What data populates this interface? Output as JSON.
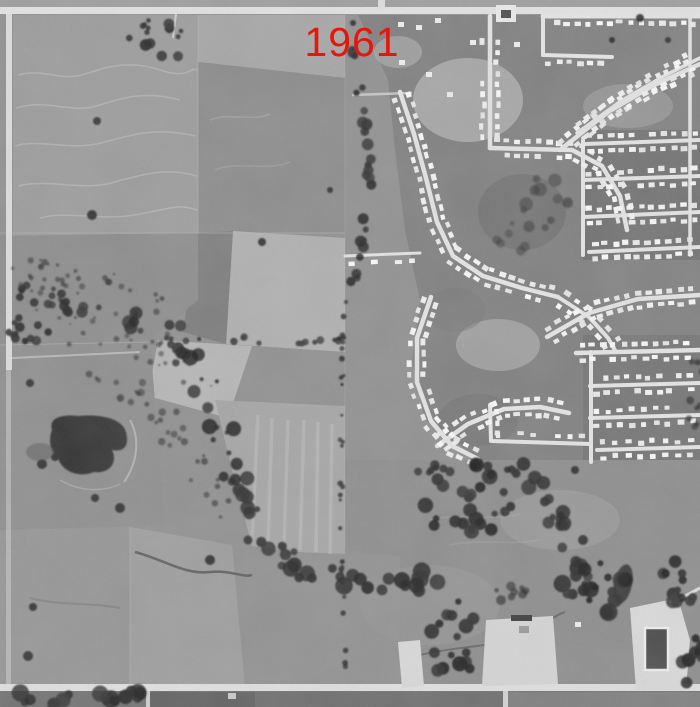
{
  "overlay": {
    "year_label": "1961",
    "color": "#e8150c"
  },
  "palette": {
    "field_mid": "#8f8f8f",
    "field_light": "#b2b2b2",
    "field_dark": "#757575",
    "suburb_ground": "#7e7e7e",
    "road": "#e6e6e6",
    "house": "#f0f0f0",
    "trees": "#262626",
    "water": "#2e2e2e"
  },
  "scene": {
    "house_defaults": {
      "spacing": 10.5,
      "offset": 7.2,
      "w": 6,
      "h": 4.6,
      "skip": 0.06
    },
    "streets": [
      {
        "pts": [
          [
            490,
            16
          ],
          [
            490,
            148
          ]
        ],
        "w": 4.5,
        "houses": {
          "sides": [
            -1,
            1
          ],
          "startD": 26
        }
      },
      {
        "pts": [
          [
            490,
            148
          ],
          [
            572,
            150
          ],
          [
            602,
            166
          ],
          [
            620,
            196
          ],
          [
            627,
            230
          ]
        ],
        "w": 4.5,
        "houses": {
          "sides": [
            -1,
            1
          ]
        }
      },
      {
        "pts": [
          [
            560,
            150
          ],
          [
            608,
            112
          ],
          [
            652,
            86
          ],
          [
            700,
            64
          ]
        ],
        "w": 4.5,
        "houses": {
          "sides": [
            -1,
            1
          ]
        }
      },
      {
        "pts": [
          [
            543,
            16
          ],
          [
            700,
            16
          ]
        ],
        "w": 5,
        "houses": {
          "sides": [
            1
          ],
          "startD": 14
        }
      },
      {
        "pts": [
          [
            577,
            133
          ],
          [
            621,
            101
          ],
          [
            664,
            76
          ],
          [
            700,
            58
          ]
        ],
        "w": 3.5,
        "houses": {
          "sides": [
            -1,
            1
          ]
        }
      },
      {
        "pts": [
          [
            400,
            92
          ],
          [
            414,
            134
          ],
          [
            426,
            178
          ],
          [
            437,
            222
          ],
          [
            453,
            256
          ],
          [
            483,
            276
          ],
          [
            522,
            288
          ],
          [
            558,
            297
          ]
        ],
        "w": 4.5,
        "houses": {
          "sides": [
            -1,
            1
          ]
        }
      },
      {
        "pts": [
          [
            431,
            297
          ],
          [
            417,
            338
          ],
          [
            417,
            382
          ],
          [
            431,
            421
          ],
          [
            452,
            446
          ],
          [
            478,
            459
          ]
        ],
        "w": 4.5,
        "houses": {
          "sides": [
            -1,
            1
          ]
        }
      },
      {
        "pts": [
          [
            558,
            297
          ],
          [
            589,
            317
          ],
          [
            608,
            338
          ],
          [
            616,
            352
          ]
        ],
        "w": 4,
        "houses": {
          "sides": [
            -1,
            1
          ],
          "spacing": 13
        }
      },
      {
        "pts": [
          [
            437,
            446
          ],
          [
            468,
            424
          ],
          [
            504,
            409
          ],
          [
            540,
            407
          ],
          [
            569,
            413
          ]
        ],
        "w": 4.5,
        "houses": {
          "sides": [
            -1,
            1
          ]
        }
      },
      {
        "pts": [
          [
            576,
            353
          ],
          [
            700,
            350
          ]
        ],
        "w": 4.5,
        "houses": {
          "sides": [
            -1,
            1
          ]
        }
      },
      {
        "pts": [
          [
            590,
            386
          ],
          [
            700,
            383
          ]
        ],
        "w": 4,
        "houses": {
          "sides": [
            -1,
            1
          ]
        }
      },
      {
        "pts": [
          [
            590,
            418
          ],
          [
            700,
            415
          ]
        ],
        "w": 4,
        "houses": {
          "sides": [
            -1,
            1
          ],
          "spacing": 12
        }
      },
      {
        "pts": [
          [
            597,
            450
          ],
          [
            700,
            447
          ]
        ],
        "w": 4,
        "houses": {
          "sides": [
            -1,
            1
          ],
          "spacing": 12.5
        }
      },
      {
        "pts": [
          [
            591,
            352
          ],
          [
            591,
            462
          ]
        ],
        "w": 4
      },
      {
        "pts": [
          [
            547,
            337
          ],
          [
            589,
            313
          ],
          [
            638,
            299
          ],
          [
            700,
            295
          ]
        ],
        "w": 4.5,
        "houses": {
          "sides": [
            -1,
            1
          ]
        }
      },
      {
        "pts": [
          [
            584,
            144
          ],
          [
            700,
            140
          ]
        ],
        "w": 4,
        "houses": {
          "sides": [
            -1,
            1
          ]
        }
      },
      {
        "pts": [
          [
            583,
            180
          ],
          [
            700,
            176
          ]
        ],
        "w": 4,
        "houses": {
          "sides": [
            -1,
            1
          ]
        }
      },
      {
        "pts": [
          [
            583,
            217
          ],
          [
            700,
            212
          ]
        ],
        "w": 4,
        "houses": {
          "sides": [
            -1,
            1
          ]
        }
      },
      {
        "pts": [
          [
            589,
            252
          ],
          [
            700,
            247
          ]
        ],
        "w": 4,
        "houses": {
          "sides": [
            -1,
            1
          ]
        }
      },
      {
        "pts": [
          [
            583,
            140
          ],
          [
            583,
            255
          ]
        ],
        "w": 4
      },
      {
        "pts": [
          [
            690,
            16
          ],
          [
            690,
            255
          ]
        ],
        "w": 3.5
      },
      {
        "pts": [
          [
            345,
            256
          ],
          [
            420,
            253
          ]
        ],
        "w": 3,
        "houses": {
          "sides": [
            1
          ],
          "skip": 0.25,
          "spacing": 12
        }
      },
      {
        "pts": [
          [
            543,
            16
          ],
          [
            543,
            55
          ]
        ],
        "w": 4
      },
      {
        "pts": [
          [
            543,
            55
          ],
          [
            612,
            57
          ]
        ],
        "w": 4,
        "houses": {
          "sides": [
            1
          ]
        }
      },
      {
        "pts": [
          [
            490,
            405
          ],
          [
            491,
            441
          ],
          [
            591,
            444
          ]
        ],
        "w": 4,
        "houses": {
          "sides": [
            -1
          ],
          "skip": 0.2,
          "spacing": 12
        }
      }
    ],
    "structures": [
      [
        399,
        60
      ],
      [
        426,
        72
      ],
      [
        447,
        92
      ],
      [
        470,
        40
      ],
      [
        398,
        22
      ],
      [
        416,
        25
      ],
      [
        514,
        42
      ],
      [
        575,
        622
      ],
      [
        435,
        18
      ]
    ],
    "tree_clusters": [
      {
        "cx": 158,
        "cy": 40,
        "rx": 30,
        "ry": 22,
        "n": 14,
        "rmin": 2,
        "rmax": 6
      },
      {
        "cx": 30,
        "cy": 330,
        "rx": 26,
        "ry": 20,
        "n": 12,
        "rmin": 2,
        "rmax": 5
      },
      {
        "cx": 470,
        "cy": 502,
        "rx": 46,
        "ry": 40,
        "n": 26,
        "rmin": 3,
        "rmax": 8
      },
      {
        "cx": 600,
        "cy": 588,
        "rx": 40,
        "ry": 26,
        "n": 18,
        "rmin": 3,
        "rmax": 9
      },
      {
        "cx": 455,
        "cy": 640,
        "rx": 28,
        "ry": 40,
        "n": 16,
        "rmin": 3,
        "rmax": 8
      },
      {
        "cx": 515,
        "cy": 593,
        "rx": 22,
        "ry": 10,
        "n": 8,
        "rmin": 2,
        "rmax": 5,
        "op": 0.6
      },
      {
        "cx": 680,
        "cy": 583,
        "rx": 20,
        "ry": 24,
        "n": 12,
        "rmin": 3,
        "rmax": 7
      },
      {
        "cx": 692,
        "cy": 662,
        "rx": 12,
        "ry": 28,
        "n": 10,
        "rmin": 3,
        "rmax": 7
      },
      {
        "cx": 548,
        "cy": 205,
        "rx": 28,
        "ry": 36,
        "n": 11,
        "rmin": 3,
        "rmax": 7,
        "op": 0.45
      },
      {
        "cx": 512,
        "cy": 238,
        "rx": 18,
        "ry": 18,
        "n": 6,
        "rmin": 2,
        "rmax": 5,
        "op": 0.4
      },
      {
        "cx": 695,
        "cy": 380,
        "rx": 8,
        "ry": 60,
        "n": 9,
        "rmin": 2,
        "rmax": 4,
        "op": 0.6
      }
    ],
    "tree_lines": [
      {
        "pts": [
          [
            0,
            288
          ],
          [
            60,
            300
          ],
          [
            120,
            318
          ],
          [
            170,
            335
          ]
        ],
        "n": 26,
        "rmin": 2,
        "rmax": 7,
        "jit": 11
      },
      {
        "pts": [
          [
            20,
            270
          ],
          [
            90,
            280
          ],
          [
            160,
            300
          ]
        ],
        "n": 30,
        "rmin": 1,
        "rmax": 3.5,
        "jit": 14,
        "op": 0.55
      },
      {
        "pts": [
          [
            170,
            335
          ],
          [
            205,
            385
          ],
          [
            225,
            440
          ],
          [
            245,
            500
          ],
          [
            262,
            545
          ]
        ],
        "n": 30,
        "rmin": 2,
        "rmax": 8,
        "jit": 12
      },
      {
        "pts": [
          [
            262,
            545
          ],
          [
            300,
            570
          ],
          [
            350,
            580
          ],
          [
            400,
            585
          ],
          [
            438,
            575
          ]
        ],
        "n": 26,
        "rmin": 3,
        "rmax": 9,
        "jit": 9
      },
      {
        "pts": [
          [
            390,
            470
          ],
          [
            450,
            468
          ],
          [
            520,
            470
          ]
        ],
        "n": 12,
        "rmin": 3,
        "rmax": 5,
        "jit": 4
      },
      {
        "pts": [
          [
            530,
            470
          ],
          [
            552,
            510
          ],
          [
            565,
            545
          ],
          [
            585,
            575
          ],
          [
            612,
            600
          ]
        ],
        "n": 20,
        "rmin": 3,
        "rmax": 8,
        "jit": 8
      },
      {
        "pts": [
          [
            0,
            695
          ],
          [
            40,
            700
          ],
          [
            90,
            698
          ],
          [
            145,
            694
          ]
        ],
        "n": 16,
        "rmin": 4,
        "rmax": 9,
        "jit": 5
      },
      {
        "pts": [
          [
            352,
            50
          ],
          [
            364,
            110
          ],
          [
            371,
            170
          ],
          [
            366,
            230
          ],
          [
            352,
            290
          ]
        ],
        "n": 26,
        "rmin": 3,
        "rmax": 6,
        "jit": 4
      },
      {
        "pts": [
          [
            346,
            300
          ],
          [
            342,
            380
          ],
          [
            341,
            460
          ],
          [
            342,
            540
          ],
          [
            344,
            620
          ],
          [
            346,
            688
          ]
        ],
        "n": 30,
        "rmin": 1.5,
        "rmax": 3,
        "jit": 2,
        "op": 0.8
      },
      {
        "pts": [
          [
            162,
            338
          ],
          [
            250,
            340
          ],
          [
            345,
            341
          ]
        ],
        "n": 16,
        "rmin": 2,
        "rmax": 4,
        "jit": 3,
        "op": 0.8
      },
      {
        "pts": [
          [
            30,
            300
          ],
          [
            90,
            320
          ],
          [
            150,
            345
          ],
          [
            200,
            370
          ]
        ],
        "n": 40,
        "rmin": 1,
        "rmax": 3,
        "jit": 18,
        "op": 0.5
      },
      {
        "pts": [
          [
            60,
            350
          ],
          [
            120,
            380
          ],
          [
            170,
            420
          ],
          [
            200,
            470
          ],
          [
            225,
            520
          ]
        ],
        "n": 34,
        "rmin": 1.5,
        "rmax": 4,
        "jit": 14,
        "op": 0.55
      }
    ],
    "single_trees": [
      [
        97,
        121,
        4
      ],
      [
        30,
        383,
        4
      ],
      [
        95,
        498,
        4
      ],
      [
        120,
        508,
        5
      ],
      [
        33,
        607,
        4
      ],
      [
        28,
        656,
        5
      ],
      [
        583,
        540,
        5
      ],
      [
        353,
        23,
        3
      ],
      [
        92,
        215,
        5
      ],
      [
        262,
        242,
        4
      ],
      [
        330,
        190,
        3
      ],
      [
        210,
        560,
        5
      ],
      [
        575,
        470,
        4
      ],
      [
        640,
        18,
        4
      ],
      [
        612,
        40,
        3
      ],
      [
        668,
        40,
        3
      ]
    ]
  }
}
